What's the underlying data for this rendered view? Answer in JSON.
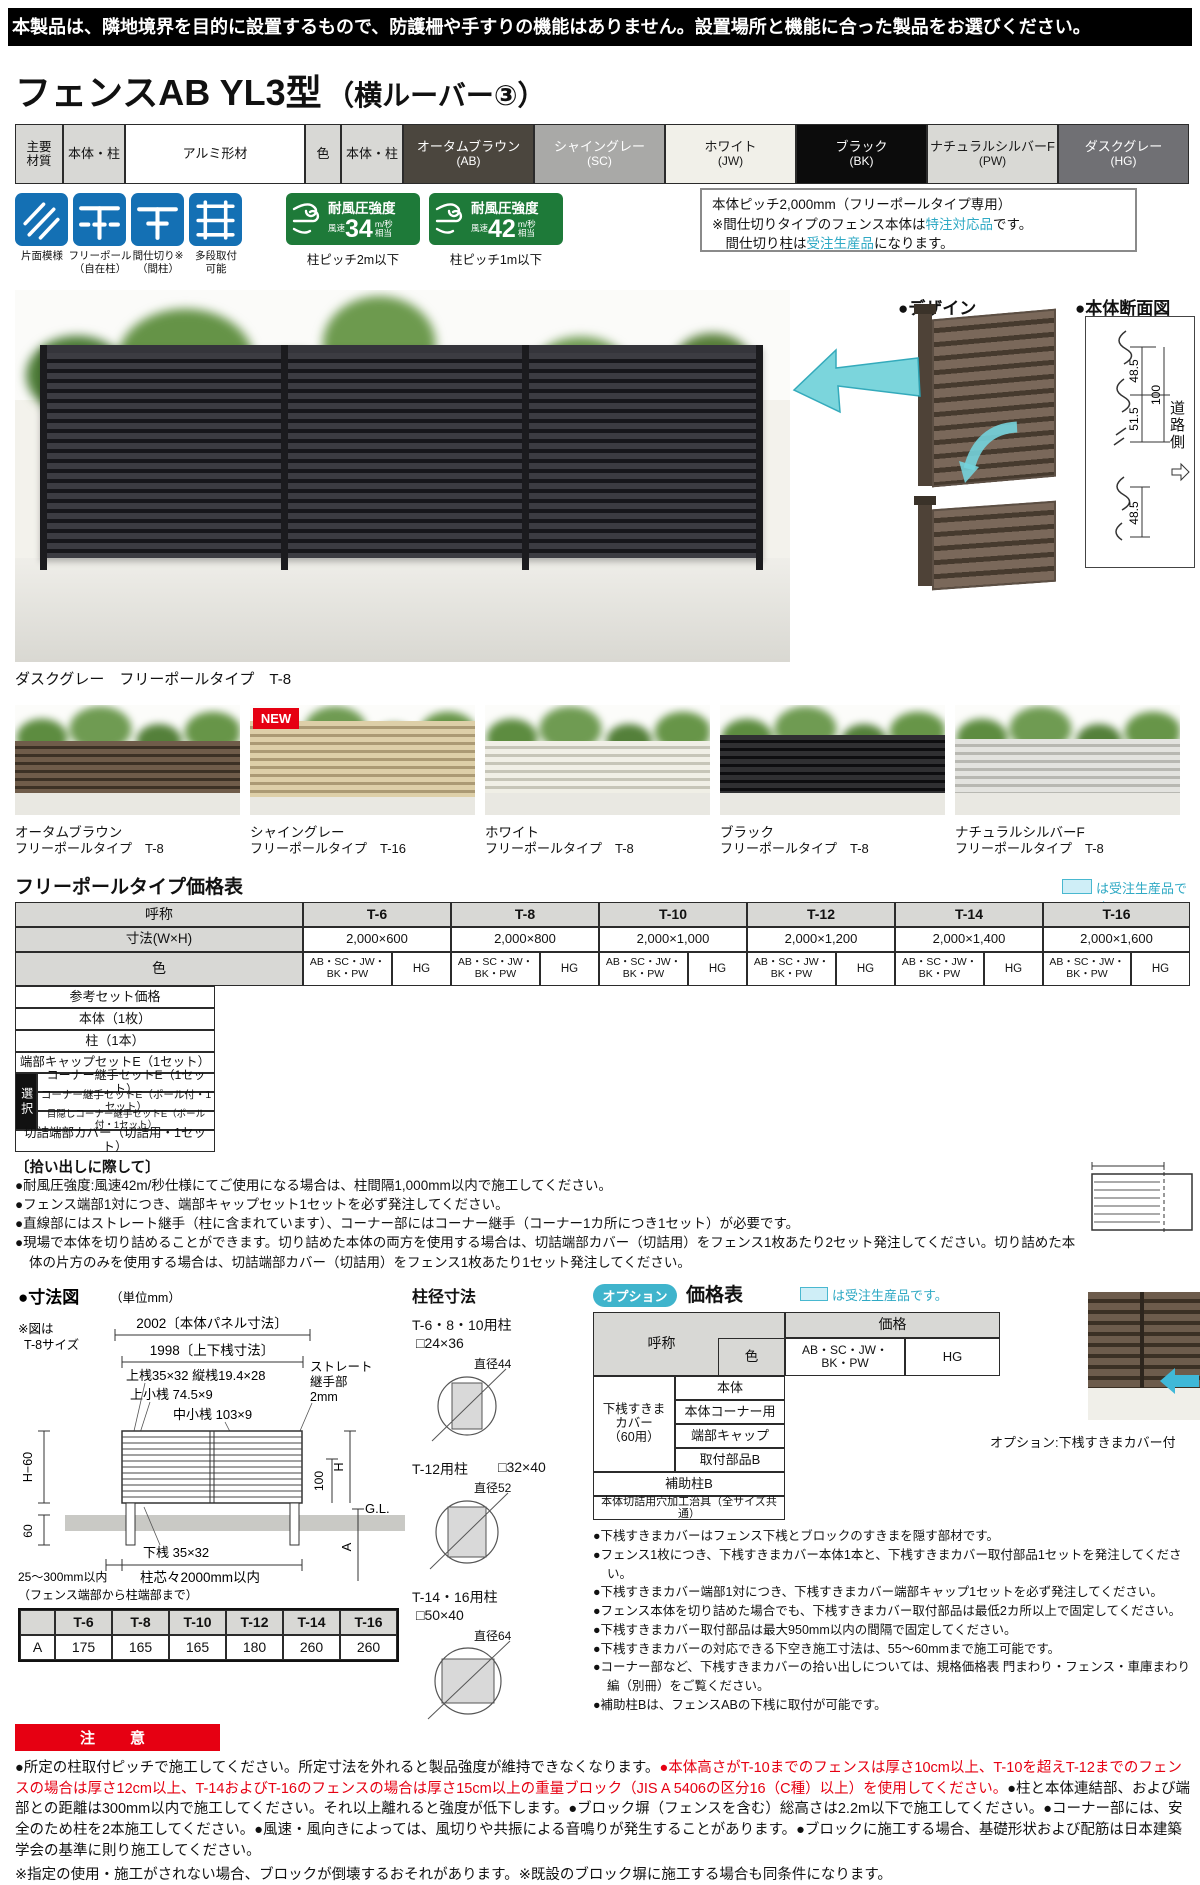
{
  "page": {
    "top_notice": "本製品は、隣地境界を目的に設置するもので、防護柵や手すりの機能はありません。設置場所と機能に合った製品をお選びください。",
    "title": "フェンスAB YL3型",
    "title_sub": "（横ルーバー③）"
  },
  "materials": {
    "h_material": "主要\n材質",
    "h_target1": "本体・柱",
    "material_value": "アルミ形材",
    "h_color": "色",
    "h_target2": "本体・柱",
    "swatches": [
      {
        "name": "オータムブラウン",
        "code": "(AB)",
        "style": "background:#4b463e;color:#fff"
      },
      {
        "name": "シャイングレー",
        "code": "(SC)",
        "style": "background:#a9a9a7;color:#fff"
      },
      {
        "name": "ホワイト",
        "code": "(JW)",
        "style": "background:#f1f0e9;color:#1a1a1a"
      },
      {
        "name": "ブラック",
        "code": "(BK)",
        "style": "background:#0c0c0c;color:#fff"
      },
      {
        "name": "ナチュラルシルバーF",
        "code": "(PW)",
        "style": "background:#d9d9d5;color:#1a1a1a"
      },
      {
        "name": "ダスクグレー",
        "code": "(HG)",
        "style": "background:#707074;color:#fff"
      }
    ]
  },
  "features": [
    {
      "line1": "片面模様",
      "line2": ""
    },
    {
      "line1": "フリーポール",
      "line2": "（自在柱）"
    },
    {
      "line1": "間仕切り※",
      "line2": "（間柱）"
    },
    {
      "line1": "多段取付",
      "line2": "可能"
    }
  ],
  "wind": [
    {
      "title": "耐風圧強度",
      "speed_label": "風速",
      "value": "34",
      "unit": "m/秒",
      "equiv": "相当",
      "note": "柱ピッチ2m以下"
    },
    {
      "title": "耐風圧強度",
      "speed_label": "風速",
      "value": "42",
      "unit": "m/秒",
      "equiv": "相当",
      "note": "柱ピッチ1m以下"
    }
  ],
  "pitch_box": {
    "line1": "本体ピッチ2,000mm（フリーポールタイプ専用）",
    "line2_pre": "※間仕切りタイプのフェンス本体は",
    "line2_hl": "特注対応品",
    "line2_post": "です。",
    "line3_pre": "　間仕切り柱は",
    "line3_hl": "受注生産品",
    "line3_post": "になります。"
  },
  "main_photo": {
    "caption": "ダスクグレー　フリーポールタイプ　T-8"
  },
  "design": {
    "title": "●デザイン",
    "front_label": "表面",
    "back_label": "裏面"
  },
  "section_view": {
    "title": "●本体断面図",
    "d1": "48.5",
    "d2": "51.5",
    "d3": "100",
    "d4": "48.5",
    "road": "道路側"
  },
  "variants": [
    {
      "name": "オータムブラウン",
      "type": "フリーポールタイプ　T-8"
    },
    {
      "name": "シャイングレー",
      "type": "フリーポールタイプ　T-16",
      "badge": "NEW"
    },
    {
      "name": "ホワイト",
      "type": "フリーポールタイプ　T-8"
    },
    {
      "name": "ブラック",
      "type": "フリーポールタイプ　T-8"
    },
    {
      "name": "ナチュラルシルバーF",
      "type": "フリーポールタイプ　T-8"
    }
  ],
  "price_table": {
    "title": "フリーポールタイプ価格表",
    "order_note": "は受注生産品です。",
    "h_name": "呼称",
    "sizes": [
      "T-6",
      "T-8",
      "T-10",
      "T-12",
      "T-14",
      "T-16"
    ],
    "h_dim": "寸法(W×H)",
    "dims": [
      "2,000×600",
      "2,000×800",
      "2,000×1,000",
      "2,000×1,200",
      "2,000×1,400",
      "2,000×1,600"
    ],
    "h_color": "色",
    "color_a": "AB・SC・JW・\nBK・PW",
    "color_b": "HG",
    "row_set": "参考セット価格",
    "row_body": "本体（1枚）",
    "row_post": "柱（1本）",
    "row_cap": "端部キャップセットE（1セット）",
    "select_label": "選択",
    "row_corner1": "コーナー継手セットE（1セット）",
    "row_corner2": "コーナー継手セットE（ポール付・1セット）",
    "row_corner3": "目隠しコーナー継手セットE（ポール付・1セット）",
    "row_cut": "切詰端部カバー（切詰用・1セット）"
  },
  "pickup": {
    "title": "〔拾い出しに際して〕",
    "notes": [
      "●耐風圧強度:風速42m/秒仕様にてご使用になる場合は、柱間隔1,000mm以内で施工してください。",
      "●フェンス端部1対につき、端部キャップセット1セットを必ず発注してください。",
      "●直線部にはストレート継手（柱に含まれています）、コーナー部にはコーナー継手（コーナー1カ所につき1セット）が必要です。",
      "●現場で本体を切り詰めることができます。切り詰めた本体の両方を使用する場合は、切詰端部カバー（切詰用）をフェンス1枚あたり2セット発注してください。切り詰めた本体の片方のみを使用する場合は、切詰端部カバー（切詰用）をフェンス1枚あたり1セット発注してください。"
    ]
  },
  "dim_fig": {
    "title": "●寸法図",
    "unit": "（単位mm）",
    "note1": "※図は",
    "note2": "T-8サイズ",
    "panel_dim": "2002〔本体パネル寸法〕",
    "rail_dim": "1998〔上下桟寸法〕",
    "top_rail": "上桟35×32 縦桟19.4×28",
    "upper_bar": "上小桟 74.5×9",
    "mid_bar": "中小桟 103×9",
    "joint1": "ストレート",
    "joint2": "継手部",
    "joint3": "2mm",
    "h60": "H−60",
    "h": "H",
    "hundred": "100",
    "gl": "G.L.",
    "bottom_rail": "下桟 35×32",
    "sixty": "60",
    "pitch": "柱芯々2000mm以内",
    "edge": "25～300mm以内",
    "edge2": "（フェンス端部から柱端部まで）",
    "a": "A"
  },
  "post_dia": {
    "title": "柱径寸法",
    "items": [
      {
        "label": "T-6・8・10用柱",
        "size": "□24×36",
        "dia": "直径44"
      },
      {
        "label": "T-12用柱",
        "size": "□32×40",
        "dia": "直径52"
      },
      {
        "label": "T-14・16用柱",
        "size": "□50×40",
        "dia": "直径64"
      }
    ]
  },
  "option_table": {
    "badge": "オプション",
    "title": "価格表",
    "order_note": "は受注生産品です。",
    "h_name": "呼称",
    "h_price": "価格",
    "h_color": "色",
    "color_a": "AB・SC・JW・\nBK・PW",
    "color_b": "HG",
    "group": "下桟すきま\nカバー\n（60用）",
    "group_rows": [
      "本体",
      "本体コーナー用",
      "端部キャップ",
      "取付部品B"
    ],
    "row_aux": "補助柱B",
    "row_jig": "本体切詰用穴加工治具（全サイズ共通）"
  },
  "option_notes": [
    "●下桟すきまカバーはフェンス下桟とブロックのすきまを隠す部材です。",
    "●フェンス1枚につき、下桟すきまカバー本体1本と、下桟すきまカバー取付部品1セットを発注してください。",
    "●下桟すきまカバー端部1対につき、下桟すきまカバー端部キャップ1セットを必ず発注してください。",
    "●フェンス本体を切り詰めた場合でも、下桟すきまカバー取付部品は最低2カ所以上で固定してください。",
    "●下桟すきまカバー取付部品は最大950mm以内の間隔で固定してください。",
    "●下桟すきまカバーの対応できる下空き施工寸法は、55～60mmまで施工可能です。",
    "●コーナー部など、下桟すきまカバーの拾い出しについては、規格価格表 門まわり・フェンス・車庫まわり編（別冊）をご覧ください。",
    "●補助柱Bは、フェンスABの下桟に取付が可能です。"
  ],
  "option_photo_caption": "オプション:下桟すきまカバー付",
  "a_table": {
    "sizes": [
      "T-6",
      "T-8",
      "T-10",
      "T-12",
      "T-14",
      "T-16"
    ],
    "row_label": "A",
    "values": [
      "175",
      "165",
      "165",
      "180",
      "260",
      "260"
    ]
  },
  "caution": {
    "banner": "注　意",
    "black1": "●所定の柱取付ピッチで施工してください。所定寸法を外れると製品強度が維持できなくなります。",
    "red": "●本体高さがT-10までのフェンスは厚さ10cm以上、T-10を超えT-12までのフェンスの場合は厚さ12cm以上、T-14およびT-16のフェンスの場合は厚さ15cm以上の重量ブロック（JIS A 5406の区分16（C種）以上）を使用してください。",
    "black2": "●柱と本体連結部、および端部との距離は300mm以内で施工してください。それ以上離れると強度が低下します。●ブロック塀（フェンスを含む）総高さは2.2m以下で施工してください。●コーナー部には、安全のため柱を2本施工してください。●風速・風向きによっては、風切りや共振による音鳴りが発生することがあります。●ブロックに施工する場合、基礎形状および配筋は日本建築学会の基準に則り施工してください。",
    "note": "※指定の使用・施工がされない場合、ブロックが倒壊するおそれがあります。※既設のブロック塀に施工する場合も同条件になります。"
  },
  "colors": {
    "accent_teal": "#3fb4cc",
    "alert_red": "#e60012",
    "badge_green": "#1e7a39",
    "icon_blue": "#1470b4"
  }
}
